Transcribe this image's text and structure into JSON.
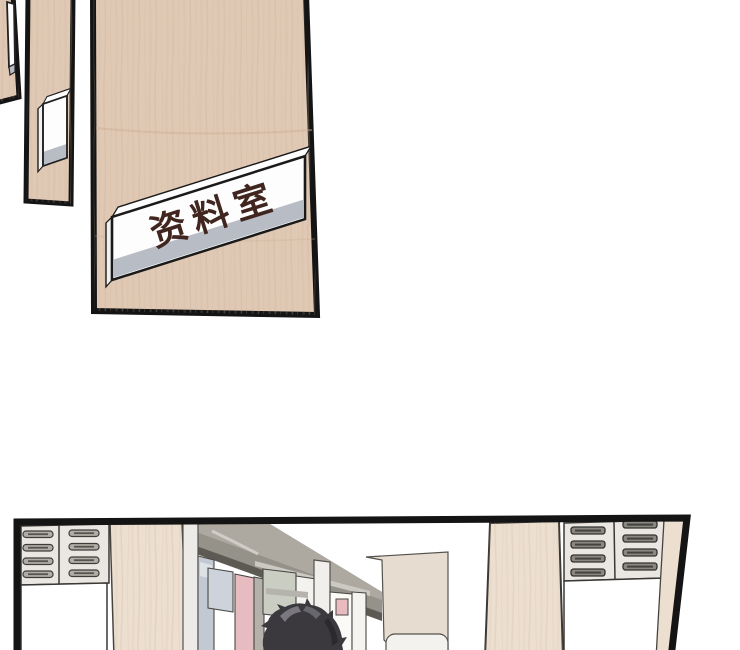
{
  "comic": {
    "door_sign_label": "资料室"
  },
  "colors": {
    "paper-white": "#ffffff",
    "outline": "#141414",
    "door-wood": "#e0c9b4",
    "wood-streak": "#c9ac93",
    "pillar-wood": "#ecdfd0",
    "sign-white": "#fdfdfd",
    "sign-strip": "#b7bcc5",
    "sign-text": "#40261f",
    "cabinet-gray": "#eae7e2",
    "cabinet-line": "#3a3835",
    "handle-gray": "#b0ada6",
    "handle-dark": "#8a8781",
    "shelf-gray": "#95928a",
    "shelf-light": "#ada9a1",
    "shelf-dark": "#5d5a54",
    "book-blue": "#c2c9d2",
    "book-lightblue": "#ccd3da",
    "book-pink": "#e7bcc0",
    "book-gray": "#b4b1ab",
    "book-green": "#c9cdc2",
    "book-cream": "#f0ebe2",
    "slab-beige": "#e6ddd0",
    "hair-dark": "#3b393e",
    "hair-light": "#908e96"
  }
}
